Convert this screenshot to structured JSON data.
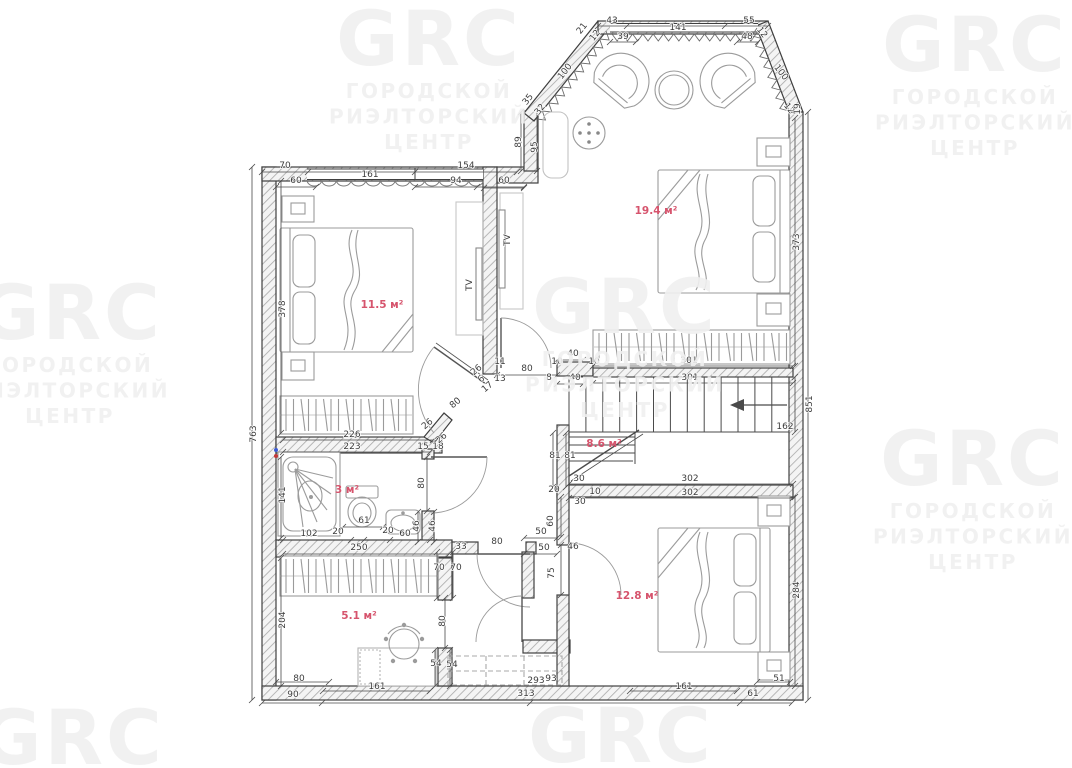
{
  "title": "floor-plan",
  "watermark": {
    "logo": "GRC",
    "line1": "ГОРОДСКОЙ",
    "line2": "РИЭЛТОРСКИЙ",
    "line3": "ЦЕНТР",
    "color": "rgba(240,240,240,0.9)",
    "positions": [
      {
        "x": 429,
        "y": 38,
        "lines": true
      },
      {
        "x": 975,
        "y": 44,
        "lines": true
      },
      {
        "x": 70,
        "y": 312,
        "lines": true
      },
      {
        "x": 625,
        "y": 306,
        "lines": true
      },
      {
        "x": 973,
        "y": 458,
        "lines": true
      },
      {
        "x": 72,
        "y": 737,
        "lines": false
      },
      {
        "x": 621,
        "y": 735,
        "lines": false
      }
    ]
  },
  "area_color": "#d6546d",
  "rooms": [
    {
      "name": "bedroom-1",
      "area_label": "11.5 м²",
      "x": 382,
      "y": 308
    },
    {
      "name": "bedroom-2",
      "area_label": "19.4 м²",
      "x": 656,
      "y": 214
    },
    {
      "name": "bathroom",
      "area_label": "3 м²",
      "x": 347,
      "y": 493
    },
    {
      "name": "hall",
      "area_label": "8.6 м²",
      "x": 604,
      "y": 447
    },
    {
      "name": "office",
      "area_label": "5.1 м²",
      "x": 359,
      "y": 619
    },
    {
      "name": "bedroom-3",
      "area_label": "12.8 м²",
      "x": 637,
      "y": 599
    }
  ],
  "furniture_labels": [
    {
      "t": "TV",
      "x": 472,
      "y": 285,
      "r": -90
    },
    {
      "t": "TV",
      "x": 510,
      "y": 240,
      "r": -90
    }
  ],
  "dimensions": [
    {
      "t": "70",
      "x": 285,
      "y": 168
    },
    {
      "t": "161",
      "x": 370,
      "y": 177
    },
    {
      "t": "154",
      "x": 466,
      "y": 168
    },
    {
      "t": "60",
      "x": 296,
      "y": 183
    },
    {
      "t": "94",
      "x": 456,
      "y": 183
    },
    {
      "t": "60",
      "x": 504,
      "y": 183
    },
    {
      "t": "43",
      "x": 612,
      "y": 23
    },
    {
      "t": "141",
      "x": 678,
      "y": 30
    },
    {
      "t": "55",
      "x": 749,
      "y": 23
    },
    {
      "t": "39",
      "x": 623,
      "y": 39
    },
    {
      "t": "48",
      "x": 747,
      "y": 39
    },
    {
      "t": "21",
      "x": 584,
      "y": 30,
      "r": -52
    },
    {
      "t": "12",
      "x": 597,
      "y": 37,
      "r": -52
    },
    {
      "t": "100",
      "x": 567,
      "y": 73,
      "r": -52
    },
    {
      "t": "35",
      "x": 530,
      "y": 101,
      "r": -52
    },
    {
      "t": "32",
      "x": 542,
      "y": 111,
      "r": -52
    },
    {
      "t": "89",
      "x": 521,
      "y": 142,
      "r": -90
    },
    {
      "t": "95",
      "x": 537,
      "y": 147,
      "r": -90
    },
    {
      "t": "12",
      "x": 760,
      "y": 34,
      "r": 52
    },
    {
      "t": "100",
      "x": 779,
      "y": 74,
      "r": 52
    },
    {
      "t": "12",
      "x": 787,
      "y": 110,
      "r": 52
    },
    {
      "t": "19",
      "x": 800,
      "y": 109,
      "r": -90
    },
    {
      "t": "763",
      "x": 256,
      "y": 434,
      "r": -90
    },
    {
      "t": "378",
      "x": 285,
      "y": 309,
      "r": -90
    },
    {
      "t": "141",
      "x": 285,
      "y": 495,
      "r": -90
    },
    {
      "t": "204",
      "x": 285,
      "y": 620,
      "r": -90
    },
    {
      "t": "373",
      "x": 799,
      "y": 242,
      "r": -90
    },
    {
      "t": "851",
      "x": 812,
      "y": 404,
      "r": -90
    },
    {
      "t": "162",
      "x": 785,
      "y": 429
    },
    {
      "t": "284",
      "x": 799,
      "y": 590,
      "r": -90
    },
    {
      "t": "226",
      "x": 352,
      "y": 437
    },
    {
      "t": "223",
      "x": 352,
      "y": 449
    },
    {
      "t": "15",
      "x": 423,
      "y": 449
    },
    {
      "t": "18",
      "x": 438,
      "y": 449
    },
    {
      "t": "80",
      "x": 527,
      "y": 371
    },
    {
      "t": "11",
      "x": 500,
      "y": 364
    },
    {
      "t": "13",
      "x": 500,
      "y": 381
    },
    {
      "t": "26",
      "x": 478,
      "y": 372,
      "r": -40
    },
    {
      "t": "6",
      "x": 483,
      "y": 381,
      "r": -40
    },
    {
      "t": "17",
      "x": 489,
      "y": 389,
      "r": -40
    },
    {
      "t": "80",
      "x": 457,
      "y": 405,
      "r": -40
    },
    {
      "t": "26",
      "x": 429,
      "y": 426,
      "r": -40
    },
    {
      "t": "26",
      "x": 443,
      "y": 440,
      "r": -40
    },
    {
      "t": "40",
      "x": 573,
      "y": 356
    },
    {
      "t": "10",
      "x": 557,
      "y": 364
    },
    {
      "t": "10",
      "x": 594,
      "y": 364
    },
    {
      "t": "301",
      "x": 689,
      "y": 363
    },
    {
      "t": "8",
      "x": 549,
      "y": 380
    },
    {
      "t": "40",
      "x": 575,
      "y": 380
    },
    {
      "t": "301",
      "x": 690,
      "y": 380
    },
    {
      "t": "81",
      "x": 555,
      "y": 458
    },
    {
      "t": "81",
      "x": 570,
      "y": 458
    },
    {
      "t": "30",
      "x": 579,
      "y": 481
    },
    {
      "t": "302",
      "x": 690,
      "y": 481
    },
    {
      "t": "20",
      "x": 554,
      "y": 492
    },
    {
      "t": "10",
      "x": 595,
      "y": 494
    },
    {
      "t": "302",
      "x": 690,
      "y": 495
    },
    {
      "t": "30",
      "x": 580,
      "y": 504
    },
    {
      "t": "60",
      "x": 553,
      "y": 521,
      "r": -90
    },
    {
      "t": "50",
      "x": 541,
      "y": 534
    },
    {
      "t": "50",
      "x": 544,
      "y": 550
    },
    {
      "t": "46",
      "x": 573,
      "y": 549
    },
    {
      "t": "75",
      "x": 554,
      "y": 573,
      "r": -90
    },
    {
      "t": "46",
      "x": 419,
      "y": 526,
      "r": -90
    },
    {
      "t": "46",
      "x": 435,
      "y": 526,
      "r": -90
    },
    {
      "t": "80",
      "x": 424,
      "y": 483,
      "r": -90
    },
    {
      "t": "102",
      "x": 309,
      "y": 536
    },
    {
      "t": "20",
      "x": 338,
      "y": 534
    },
    {
      "t": "61",
      "x": 364,
      "y": 523
    },
    {
      "t": "20",
      "x": 388,
      "y": 533
    },
    {
      "t": "60",
      "x": 405,
      "y": 536
    },
    {
      "t": "250",
      "x": 359,
      "y": 550
    },
    {
      "t": "33",
      "x": 461,
      "y": 549
    },
    {
      "t": "80",
      "x": 497,
      "y": 544
    },
    {
      "t": "70",
      "x": 439,
      "y": 570
    },
    {
      "t": "70",
      "x": 456,
      "y": 570
    },
    {
      "t": "80",
      "x": 445,
      "y": 621,
      "r": -90
    },
    {
      "t": "80",
      "x": 299,
      "y": 681
    },
    {
      "t": "54",
      "x": 436,
      "y": 666
    },
    {
      "t": "54",
      "x": 452,
      "y": 667
    },
    {
      "t": "90",
      "x": 293,
      "y": 697
    },
    {
      "t": "161",
      "x": 377,
      "y": 689
    },
    {
      "t": "313",
      "x": 526,
      "y": 696
    },
    {
      "t": "293",
      "x": 536,
      "y": 683
    },
    {
      "t": "93",
      "x": 551,
      "y": 681
    },
    {
      "t": "161",
      "x": 684,
      "y": 689
    },
    {
      "t": "61",
      "x": 753,
      "y": 696
    },
    {
      "t": "51",
      "x": 779,
      "y": 681
    }
  ]
}
